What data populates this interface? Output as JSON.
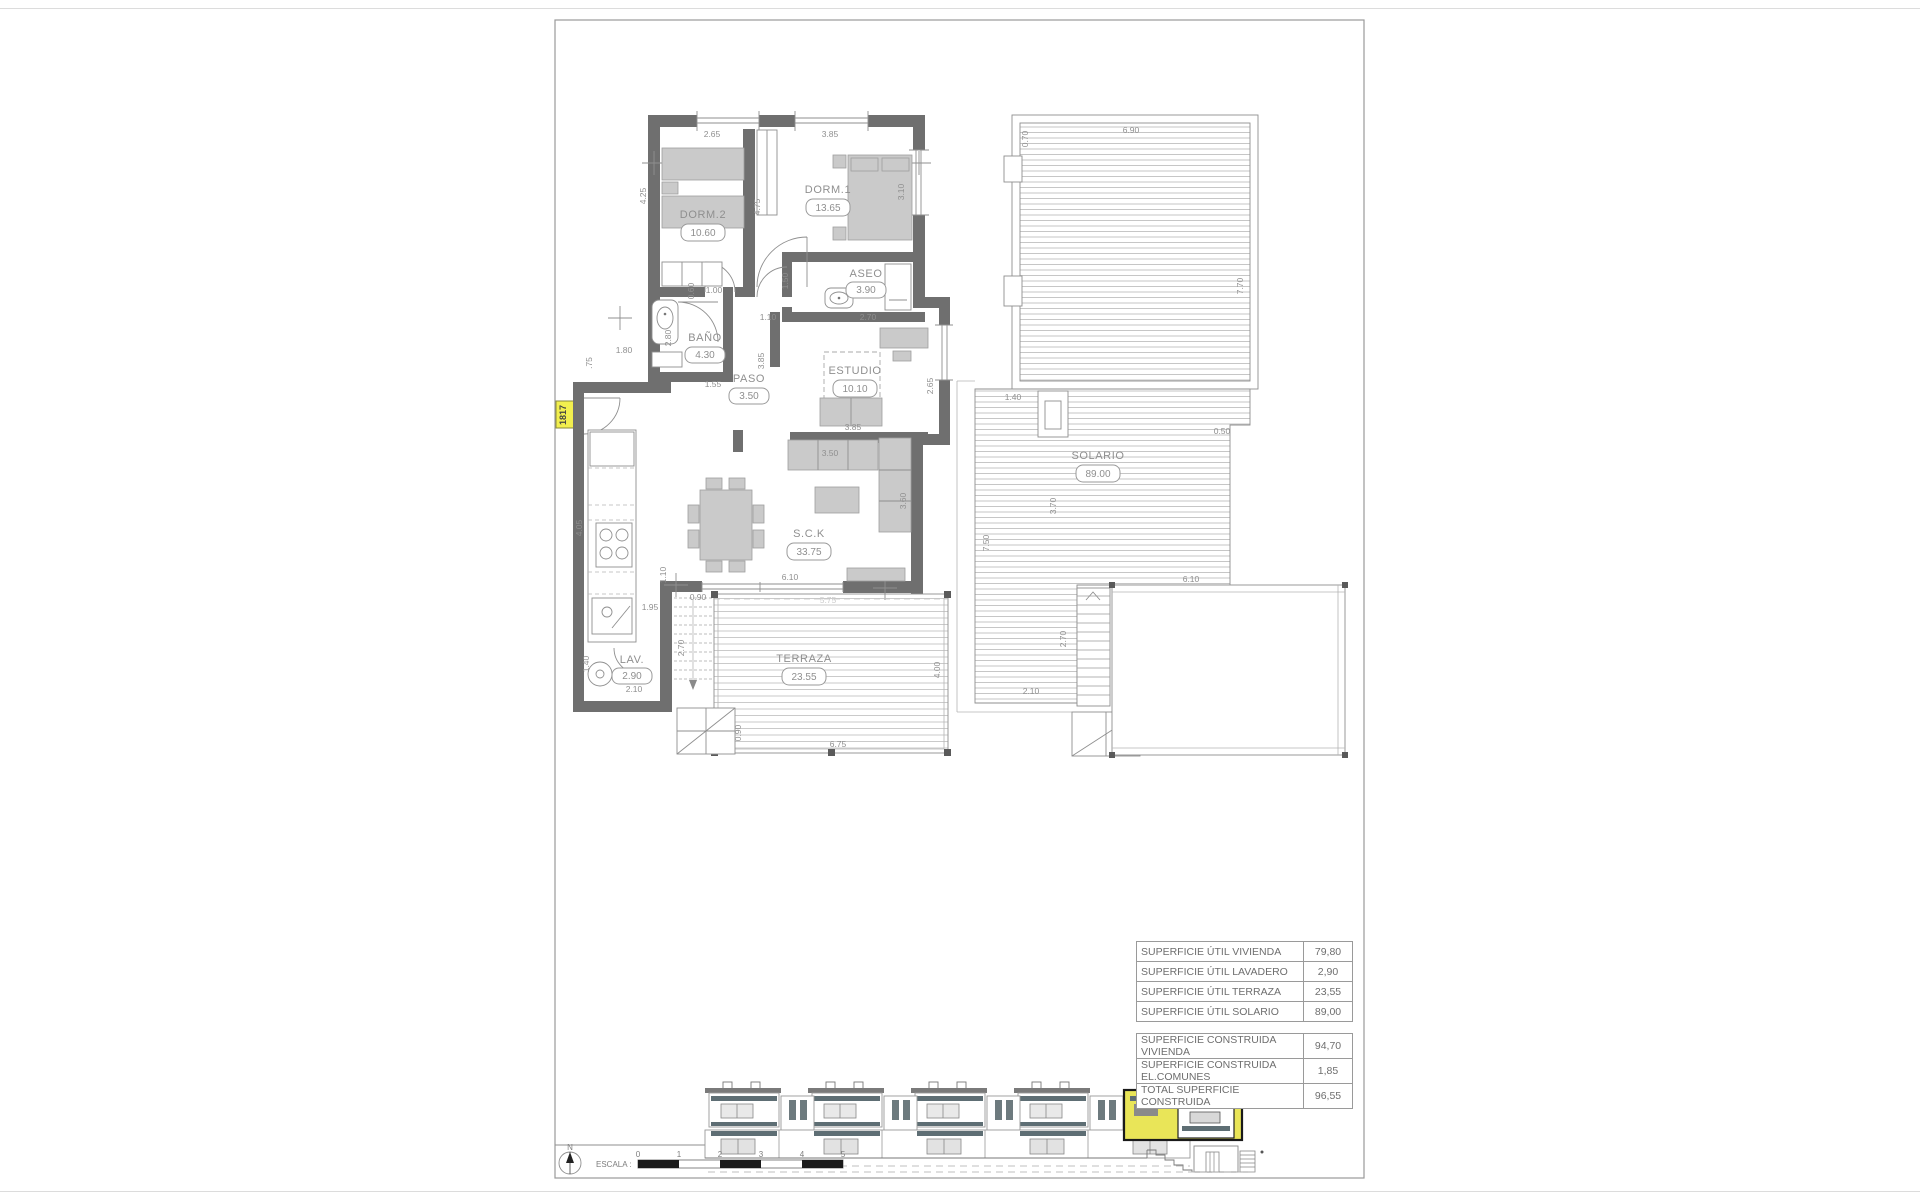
{
  "plan": {
    "unit_tag": "1817",
    "rooms": [
      {
        "id": "dorm2",
        "label": "DORM.2",
        "area": "10.60"
      },
      {
        "id": "dorm1",
        "label": "DORM.1",
        "area": "13.65"
      },
      {
        "id": "aseo",
        "label": "ASEO",
        "area": "3.90"
      },
      {
        "id": "bano",
        "label": "BAÑO",
        "area": "4.30"
      },
      {
        "id": "paso",
        "label": "PASO",
        "area": "3.50"
      },
      {
        "id": "estudio",
        "label": "ESTUDIO",
        "area": "10.10"
      },
      {
        "id": "sck",
        "label": "S.C.K",
        "area": "33.75"
      },
      {
        "id": "lav",
        "label": "LAV.",
        "area": "2.90"
      },
      {
        "id": "terraza",
        "label": "TERRAZA",
        "area": "23.55"
      },
      {
        "id": "solario",
        "label": "SOLARIO",
        "area": "89.00"
      }
    ],
    "dims": [
      {
        "v": "2.65"
      },
      {
        "v": "3.85"
      },
      {
        "v": "4.25"
      },
      {
        "v": "4.75"
      },
      {
        "v": "3.10"
      },
      {
        "v": "0.60"
      },
      {
        "v": "1.00"
      },
      {
        "v": "1.50"
      },
      {
        "v": "2.70"
      },
      {
        "v": "1.10"
      },
      {
        "v": "3.85"
      },
      {
        "v": "2.80"
      },
      {
        "v": "1.55"
      },
      {
        "v": "1.80"
      },
      {
        "v": ".75"
      },
      {
        "v": "2.65"
      },
      {
        "v": "3.85"
      },
      {
        "v": "3.50"
      },
      {
        "v": "3.60"
      },
      {
        "v": "4.05"
      },
      {
        "v": "1.95"
      },
      {
        "v": "1.10"
      },
      {
        "v": "0.90"
      },
      {
        "v": "2.70"
      },
      {
        "v": "1.40"
      },
      {
        "v": "2.10"
      },
      {
        "v": "6.10"
      },
      {
        "v": "5.75"
      },
      {
        "v": "4.00"
      },
      {
        "v": "6.75"
      },
      {
        "v": "0.90"
      },
      {
        "v": "6.90"
      },
      {
        "v": "0.70"
      },
      {
        "v": "7.70"
      },
      {
        "v": "0.50"
      },
      {
        "v": "1.40"
      },
      {
        "v": "7.50"
      },
      {
        "v": "2.70"
      },
      {
        "v": "2.10"
      },
      {
        "v": "6.10"
      },
      {
        "v": "3.70"
      }
    ]
  },
  "area_tables": {
    "util": {
      "rows": [
        {
          "label": "SUPERFICIE ÚTIL VIVIENDA",
          "value": "79,80"
        },
        {
          "label": "SUPERFICIE ÚTIL LAVADERO",
          "value": "2,90"
        },
        {
          "label": "SUPERFICIE ÚTIL TERRAZA",
          "value": "23,55"
        },
        {
          "label": "SUPERFICIE ÚTIL SOLARIO",
          "value": "89,00"
        }
      ]
    },
    "construida": {
      "rows": [
        {
          "label": "SUPERFICIE CONSTRUIDA VIVIENDA",
          "value": "94,70"
        },
        {
          "label": "SUPERFICIE CONSTRUIDA EL.COMUNES",
          "value": "1,85"
        },
        {
          "label": "TOTAL SUPERFICIE CONSTRUIDA",
          "value": "96,55"
        }
      ]
    }
  },
  "footer": {
    "scale_label": "ESCALA :",
    "scale_ticks": [
      "0",
      "1",
      "2",
      "3",
      "4",
      "5"
    ],
    "north_label": "N"
  },
  "colors": {
    "wall": "#6f6f6f",
    "furniture": "#cacaca",
    "highlight_yellow": "#e9e558",
    "hatch": "#b8b8b8",
    "railing_dark": "#5e6e74"
  }
}
